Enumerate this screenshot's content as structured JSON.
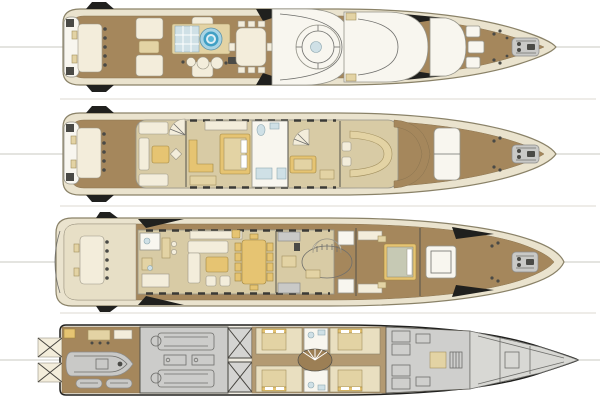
{
  "image": {
    "type": "yacht-deck-plans",
    "orientation": "bow-right",
    "deck_count": 4,
    "background": "#ffffff",
    "text_labels": []
  },
  "palette": {
    "page_bg": "#ffffff",
    "deck_wood": "#a5875c",
    "deck_wood_light": "#b39a72",
    "hull_cream": "#eae3ce",
    "hull_stroke": "#8a8268",
    "superstructure_white": "#f8f6ef",
    "structure_stroke": "#95948a",
    "furniture_cream": "#f3eddb",
    "tan_light": "#e7dfc6",
    "furniture_khaki": "#e3d3a4",
    "furniture_gold": "#e6c472",
    "interior_beige": "#d8cba5",
    "cabin_cream": "#e9dfc0",
    "glass_blue": "#cfe0e6",
    "jacuzzi_blue": "#3f9fc4",
    "engine_gray": "#c9c9c7",
    "bow_gray": "#d8d8d4",
    "line_dark": "#4a4a46",
    "shadow_black": "#20201e",
    "centerline": "#c8c8c2"
  },
  "decks": [
    {
      "id": "sun-deck",
      "position": 1,
      "features": [
        "aft-lounge-table-with-chairs",
        "sun-loungers",
        "spa-pool-jacuzzi",
        "glass-sunpad-panels",
        "bar-stools",
        "open-dining-table-8-seats",
        "satellite-dome-ring",
        "radar-arch",
        "foredeck-seating-boxes",
        "mooring-bollards",
        "anchor-windlass"
      ]
    },
    {
      "id": "bridge-deck",
      "position": 2,
      "features": [
        "aft-dining-table-with-chairs",
        "sky-lounge-sofas",
        "gold-coffee-table",
        "spiral-staircase",
        "vip-stateroom-double-bed",
        "bathroom",
        "captain-cabin",
        "wheelhouse-curved-console",
        "helm-seats",
        "teak-wing-walkway",
        "foredeck-seating-box",
        "mooring-bollards",
        "anchor-windlass"
      ]
    },
    {
      "id": "main-deck",
      "position": 3,
      "features": [
        "transom-boarding",
        "aft-deck-table-with-chairs",
        "day-head",
        "bar-with-stools",
        "u-shaped-salon-sofa",
        "gold-coffee-table",
        "armchairs",
        "formal-dining-table-10-seats",
        "galley-counters",
        "oval-lobby-with-staircase",
        "master-stateroom-bed",
        "his-and-hers-bathrooms",
        "foredeck-hatch",
        "mooring-bollards",
        "anchor-windlass"
      ]
    },
    {
      "id": "lower-deck",
      "position": 4,
      "features": [
        "swim-platform-stairs",
        "tender-garage",
        "tender-boat",
        "jet-skis",
        "crew-mess",
        "engine-room",
        "twin-main-engines",
        "two-generators",
        "tank-bulkhead-cross-braced",
        "four-guest-cabins-with-beds",
        "guest-bathrooms",
        "lobby-curved-staircase",
        "crew-cabins-bunks",
        "crew-corridor",
        "bow-storage-chain-locker"
      ]
    }
  ]
}
